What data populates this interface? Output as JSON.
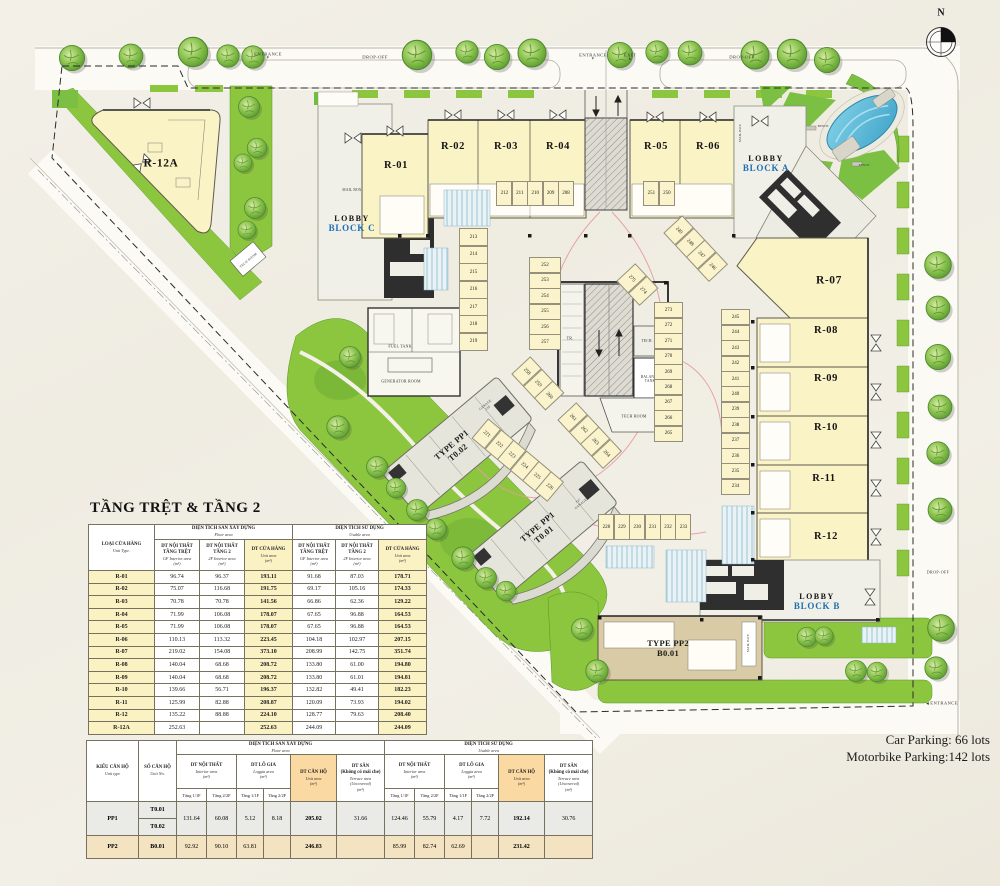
{
  "notes": {
    "car_parking": "Car Parking:  66 lots",
    "motorbike_parking": "Motorbike Parking:142 lots"
  },
  "plan": {
    "north": "N",
    "icons": {
      "down": "▼",
      "up": "▲",
      "left": "◀"
    },
    "road_labels": {
      "entrance_tl": "ENTRANCE",
      "dropoff_tl": "DROP-OFF",
      "entrance_tm": "ENTRANCE",
      "exit_tm": "EXIT",
      "dropoff_tr": "DROP-OFF",
      "dropoff_r": "DROP-OFF",
      "entrance_br": "ENTRANCE"
    },
    "units": {
      "r01": "R-01",
      "r02": "R-02",
      "r03": "R-03",
      "r04": "R-04",
      "r05": "R-05",
      "r06": "R-06",
      "r07": "R-07",
      "r08": "R-08",
      "r09": "R-09",
      "r10": "R-10",
      "r11": "R-11",
      "r12": "R-12",
      "r12a": "R-12A"
    },
    "lobby_a": {
      "l1": "LOBBY",
      "l2": "BLOCK A"
    },
    "lobby_b": {
      "l1": "LOBBY",
      "l2": "BLOCK B"
    },
    "lobby_c": {
      "l1": "LOBBY",
      "l2": "BLOCK C"
    },
    "pp1_t002": {
      "l1": "TYPE PP1",
      "l2": "T0.02"
    },
    "pp1_t001": {
      "l1": "TYPE PP1",
      "l2": "T0.01"
    },
    "pp2": {
      "l1": "TYPE PP2",
      "l2": "B0.01"
    },
    "rooms": {
      "tech_room_w": "TECH ROOM",
      "fuel_tank": "FUEL TANK",
      "generator_room": "GENERATOR ROOM",
      "tr": "TR.",
      "tech_r": "TECH. R",
      "balance_tank": "BALANCE\nTANK",
      "tech_room_c": "TECH ROOM",
      "garage_220": "GARAGE\n220",
      "garage_227": "227\nGARAGE",
      "mail_box_c": "MAIL BOX",
      "mail_box_a": "MAIL BOX",
      "mail_box_b": "MAIL BOX",
      "bench_1": "BENCH",
      "bench_2": "BENCH"
    },
    "parking": {
      "g208": [
        "212",
        "211",
        "210",
        "209",
        "208"
      ],
      "g250": [
        "251",
        "250"
      ],
      "g213": [
        "213",
        "214",
        "215",
        "216",
        "217",
        "218",
        "219"
      ],
      "g252": [
        "252",
        "253",
        "254",
        "255",
        "256",
        "257"
      ],
      "g258": [
        "258",
        "259",
        "260"
      ],
      "g261": [
        "261",
        "262",
        "263",
        "264"
      ],
      "g274": [
        "275",
        "274"
      ],
      "g265": [
        "273",
        "272",
        "271",
        "270",
        "269",
        "268",
        "267",
        "266",
        "265"
      ],
      "g246": [
        "249",
        "248",
        "247",
        "246"
      ],
      "g234": [
        "245",
        "244",
        "243",
        "242",
        "241",
        "240",
        "239",
        "238",
        "237",
        "236",
        "235",
        "234"
      ],
      "g228": [
        "228",
        "229",
        "230",
        "231",
        "232",
        "233"
      ],
      "g221": [
        "221",
        "222",
        "223",
        "224",
        "225",
        "226"
      ]
    }
  },
  "main_table": {
    "title": "TẦNG TRỆT & TẦNG 2",
    "col_unit_type": {
      "vn": "LOẠI CỬA HÀNG",
      "en": "Unit Type."
    },
    "floor_group": {
      "vn": "DIỆN TÍCH SÀN XÂY DỰNG",
      "en": "Floor area"
    },
    "usable_group": {
      "vn": "DIỆN TÍCH SỬ DỤNG",
      "en": "Usable area"
    },
    "sub_gf": {
      "vn": "DT NỘI THẤT\nTẦNG TRỆT",
      "en": "GF Interior area\n(m²)"
    },
    "sub_2f": {
      "vn": "DT NỘI THẤT\nTẦNG 2",
      "en": "2F Interior area\n(m²)"
    },
    "sub_unit": {
      "vn": "DT CỬA HÀNG",
      "en": "Unit area\n(m²)"
    },
    "rows": [
      [
        "R-01",
        "96.74",
        "96.37",
        "193.11",
        "91.68",
        "87.03",
        "178.71"
      ],
      [
        "R-02",
        "75.07",
        "116.68",
        "191.75",
        "69.17",
        "105.16",
        "174.33"
      ],
      [
        "R-03",
        "70.78",
        "70.78",
        "141.56",
        "66.86",
        "62.36",
        "129.22"
      ],
      [
        "R-04",
        "71.99",
        "106.08",
        "178.07",
        "67.65",
        "96.88",
        "164.53"
      ],
      [
        "R-05",
        "71.99",
        "106.08",
        "178.07",
        "67.65",
        "96.88",
        "164.53"
      ],
      [
        "R-06",
        "110.13",
        "113.32",
        "223.45",
        "104.18",
        "102.97",
        "207.15"
      ],
      [
        "R-07",
        "219.02",
        "154.08",
        "373.10",
        "208.99",
        "142.75",
        "351.74"
      ],
      [
        "R-08",
        "140.04",
        "68.68",
        "208.72",
        "133.80",
        "61.00",
        "194.80"
      ],
      [
        "R-09",
        "140.04",
        "68.68",
        "208.72",
        "133.80",
        "61.01",
        "194.81"
      ],
      [
        "R-10",
        "139.66",
        "56.71",
        "196.37",
        "132.82",
        "49.41",
        "182.23"
      ],
      [
        "R-11",
        "125.99",
        "82.88",
        "208.87",
        "120.09",
        "73.93",
        "194.02"
      ],
      [
        "R-12",
        "135.22",
        "88.88",
        "224.10",
        "128.77",
        "79.63",
        "208.40"
      ],
      [
        "R-12A",
        "252.63",
        "",
        "252.63",
        "244.09",
        "",
        "244.09"
      ]
    ]
  },
  "pp_table": {
    "col_type": {
      "vn": "KIỂU CĂN HỘ",
      "en": "Unit type"
    },
    "col_no": {
      "vn": "SỐ CĂN HỘ",
      "en": "Unit No."
    },
    "floor_group": {
      "vn": "DIỆN TÍCH SÀN XÂY DỰNG",
      "en": "Floor area"
    },
    "usable_group": {
      "vn": "DIỆN TÍCH SỬ DỤNG",
      "en": "Usable area"
    },
    "sub_interior": {
      "vn": "DT NỘI THẤT",
      "en": "Interior area\n(m²)"
    },
    "sub_loggia": {
      "vn": "DT LÔ GIA",
      "en": "Loggia area\n(m²)"
    },
    "sub_unit": {
      "vn": "DT CĂN HỘ",
      "en": "Unit area\n(m²)"
    },
    "sub_terrace": {
      "vn": "DT SÂN\n(Không có mái che)",
      "en": "Terrace area\n(Uncovered)\n(m²)"
    },
    "tier3": {
      "t1": "Tầng 1/1F",
      "t2": "Tầng 2/2F"
    },
    "pp1": {
      "type": "PP1",
      "no1": "T0.01",
      "no2": "T0.02",
      "f_i1": "131.64",
      "f_i2": "60.08",
      "f_l1": "5.12",
      "f_l2": "8.18",
      "f_u": "205.02",
      "f_t": "31.66",
      "u_i1": "124.46",
      "u_i2": "55.79",
      "u_l1": "4.17",
      "u_l2": "7.72",
      "u_u": "192.14",
      "u_t": "30.76"
    },
    "pp2": {
      "type": "PP2",
      "no": "B0.01",
      "f_i1": "92.92",
      "f_i2": "90.10",
      "f_l1": "63.81",
      "f_l2": "",
      "f_u": "246.83",
      "f_t": "",
      "u_i1": "85.99",
      "u_i2": "82.74",
      "u_l1": "62.69",
      "u_l2": "",
      "u_u": "231.42",
      "u_t": ""
    }
  }
}
